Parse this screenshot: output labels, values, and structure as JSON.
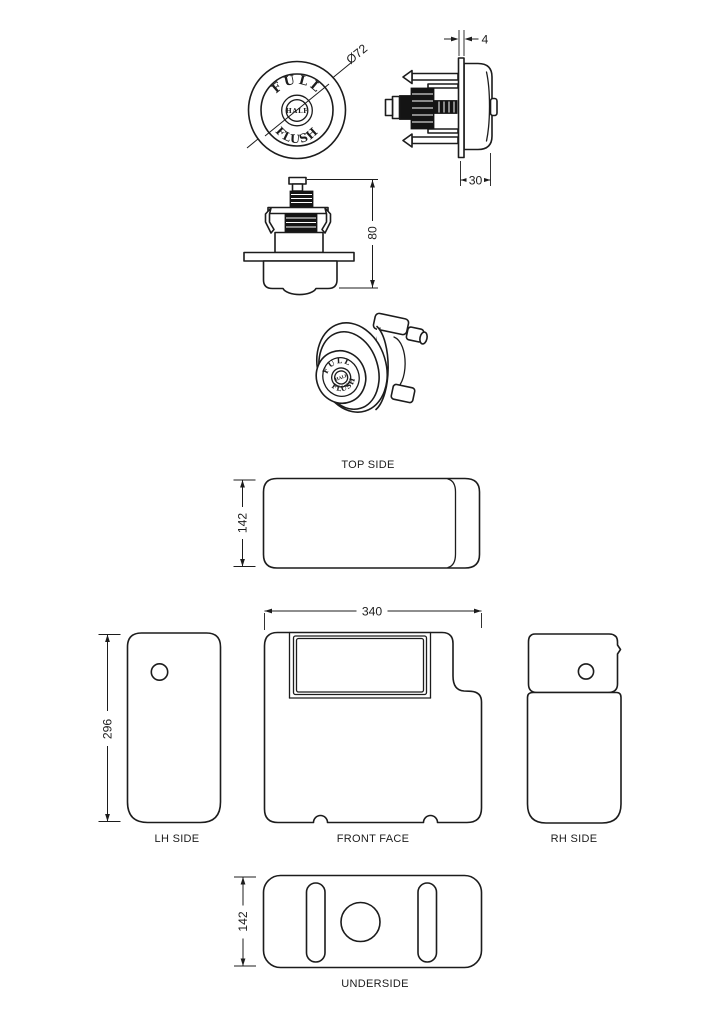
{
  "colors": {
    "background": "#ffffff",
    "line": "#1c1c1c"
  },
  "button": {
    "labels": {
      "full": "FULL",
      "half": "HALF",
      "flush": "FLUSH"
    },
    "dims": {
      "diameter": "Ø72",
      "plate_thickness": "4",
      "projection": "30",
      "height": "80"
    }
  },
  "cistern": {
    "dims": {
      "top_depth": "142",
      "lh_height": "296",
      "front_width": "340",
      "underside_depth": "142"
    },
    "views": {
      "top": "TOP SIDE",
      "lh": "LH SIDE",
      "front": "FRONT FACE",
      "rh": "RH SIDE",
      "underside": "UNDERSIDE"
    }
  }
}
